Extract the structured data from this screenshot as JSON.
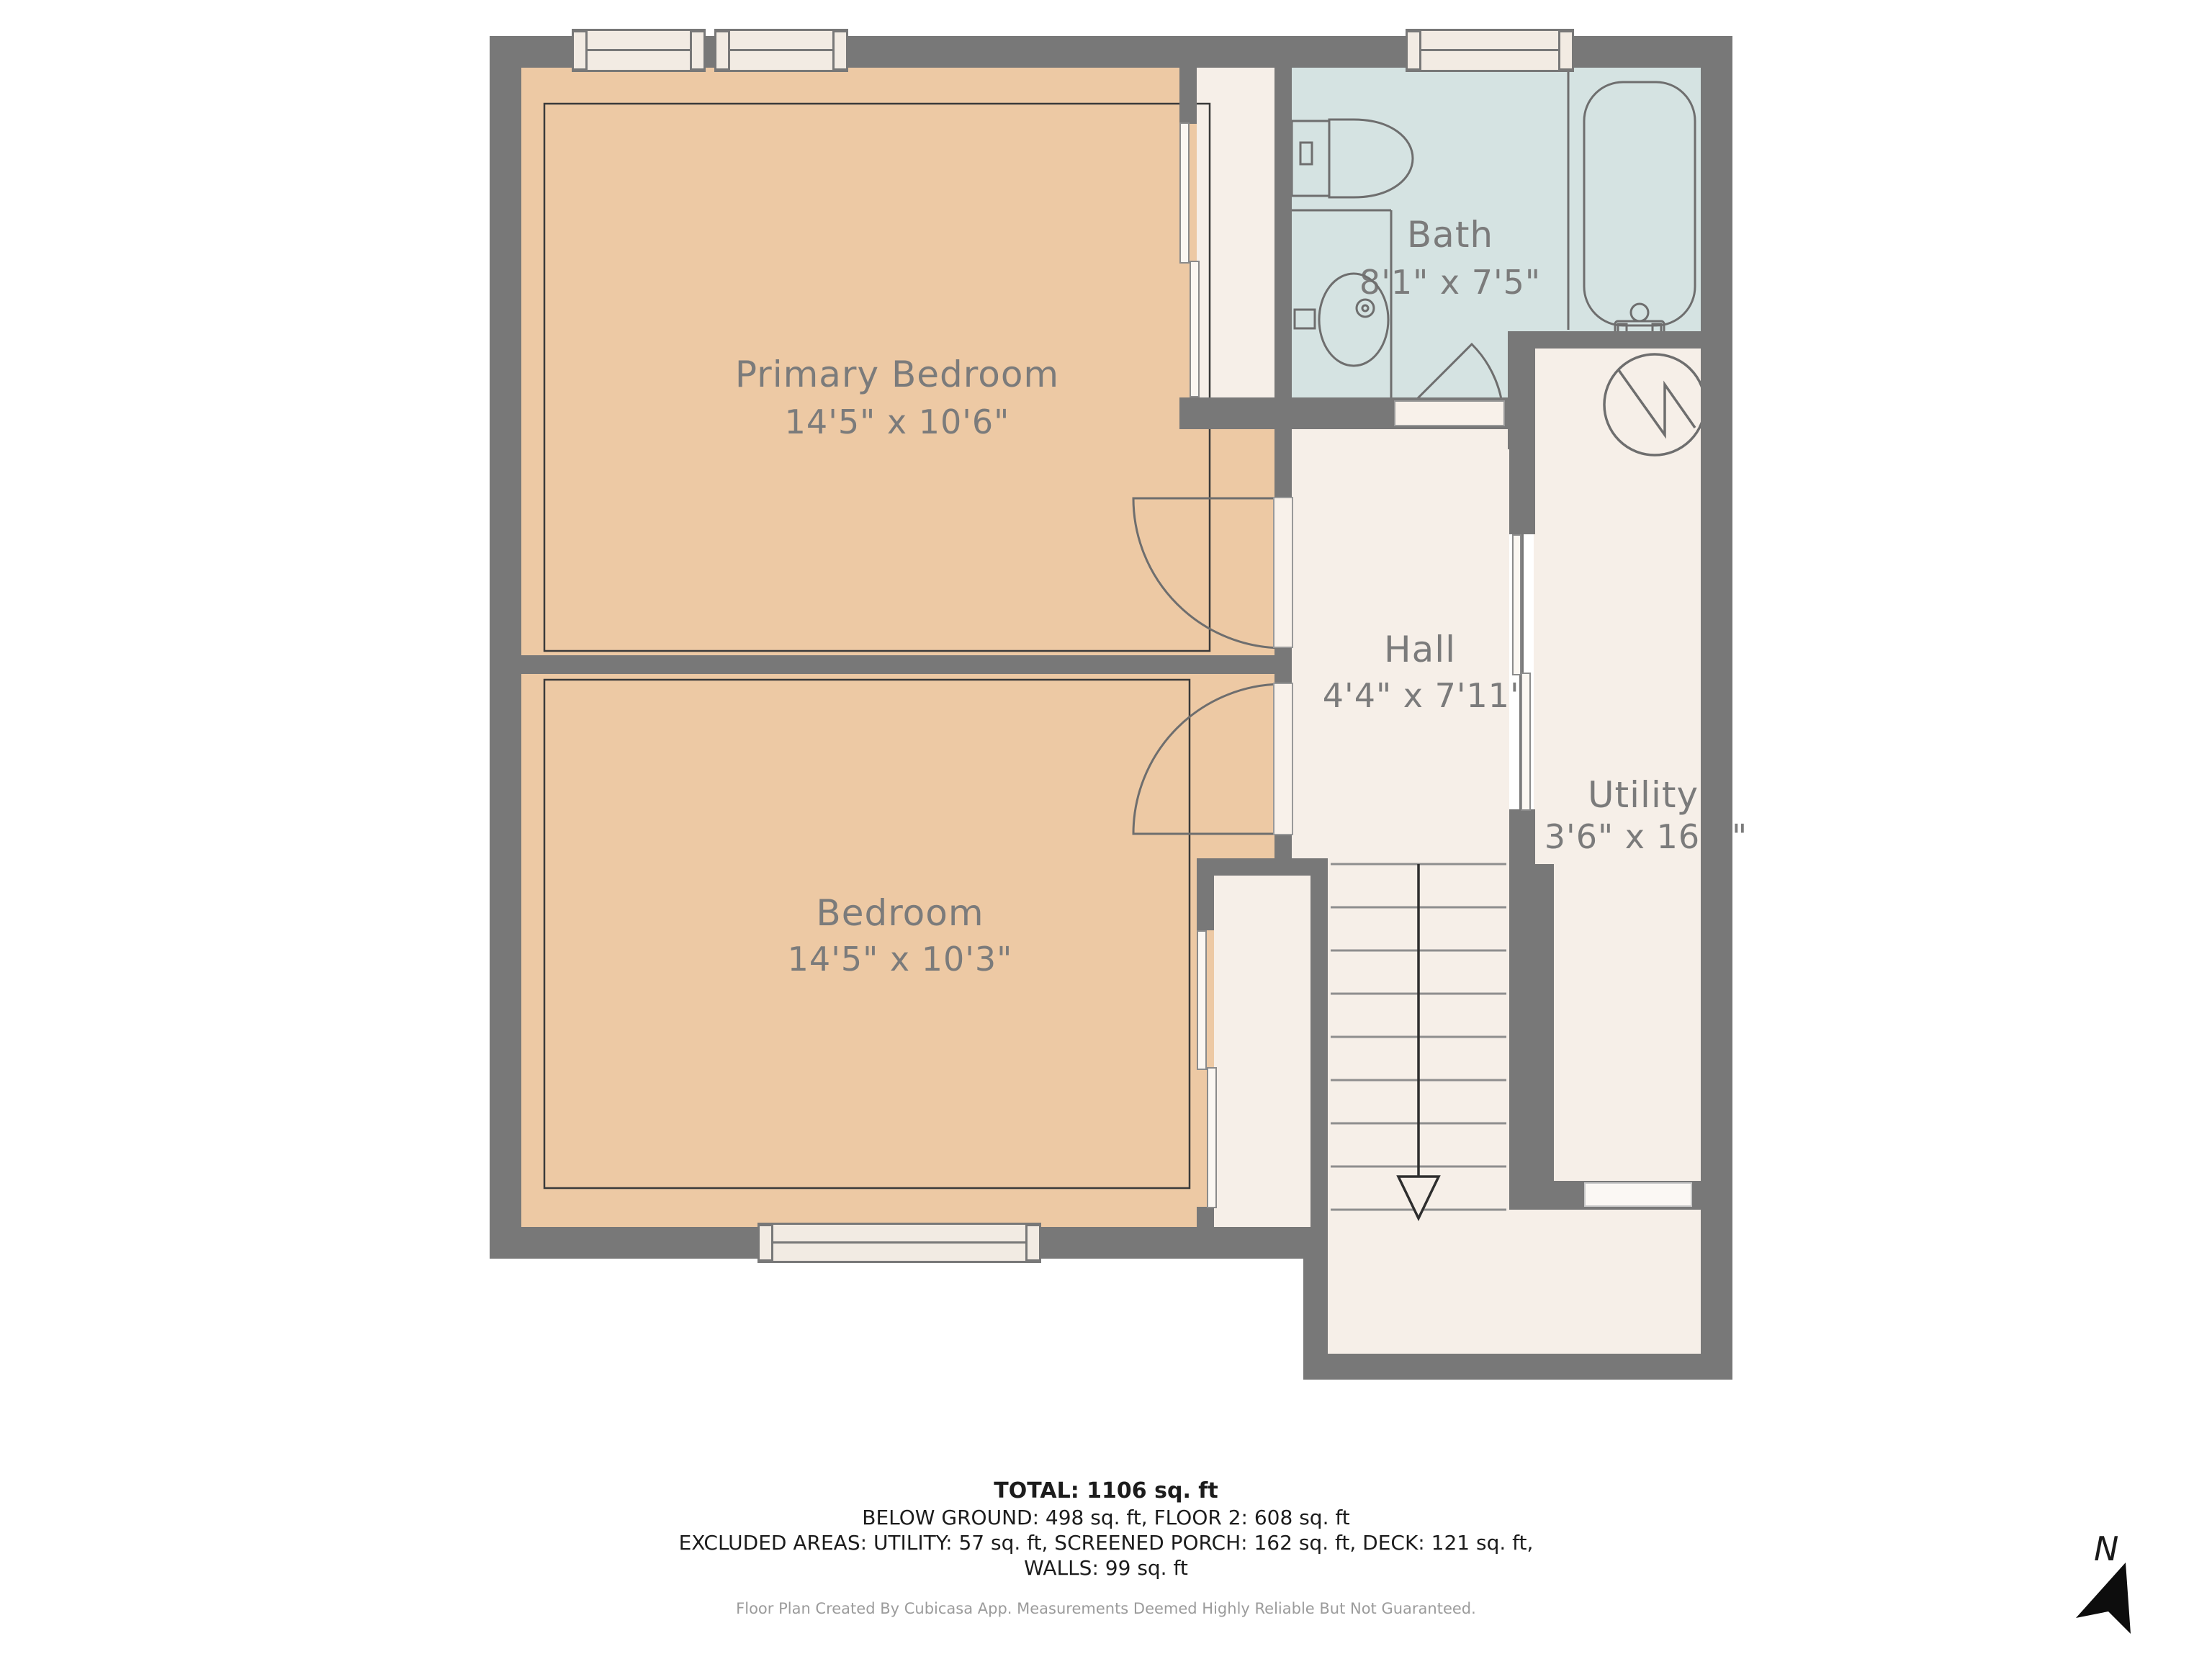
{
  "page": {
    "background": "#ffffff"
  },
  "floorplan": {
    "wall_color": "#787878",
    "label_color": "#7b7b7b",
    "rooms": [
      {
        "id": "primary-bedroom",
        "name": "Primary Bedroom",
        "dimensions": "14'5\" x 10'6\"",
        "fill": "#edc9a4"
      },
      {
        "id": "bedroom",
        "name": "Bedroom",
        "dimensions": "14'5\" x 10'3\"",
        "fill": "#edc9a4"
      },
      {
        "id": "bath",
        "name": "Bath",
        "dimensions": "8'1\" x 7'5\"",
        "fill": "#d5e3e2"
      },
      {
        "id": "hall",
        "name": "Hall",
        "dimensions": "4'4\" x 7'11\"",
        "fill": "#f6efe8"
      },
      {
        "id": "utility",
        "name": "Utility",
        "dimensions": "3'6\" x 16'4\"",
        "fill": "#f6efe8"
      }
    ],
    "fixtures": [
      "toilet",
      "sink",
      "vanity-counter",
      "bathtub",
      "tub-faucet",
      "washer-dryer-symbol",
      "stairs-down-arrow",
      "window",
      "sliding-door",
      "door-swing"
    ]
  },
  "summary": {
    "total": "TOTAL: 1106 sq. ft",
    "below_ground": "BELOW GROUND: 498 sq. ft, FLOOR 2: 608 sq. ft",
    "excluded": "EXCLUDED AREAS: UTILITY: 57 sq. ft, SCREENED PORCH: 162 sq. ft, DECK: 121 sq. ft,",
    "walls": "WALLS: 99 sq. ft"
  },
  "footer": {
    "disclaimer": "Floor Plan Created By Cubicasa App. Measurements Deemed Highly Reliable But Not Guaranteed."
  },
  "compass": {
    "label": "N"
  }
}
